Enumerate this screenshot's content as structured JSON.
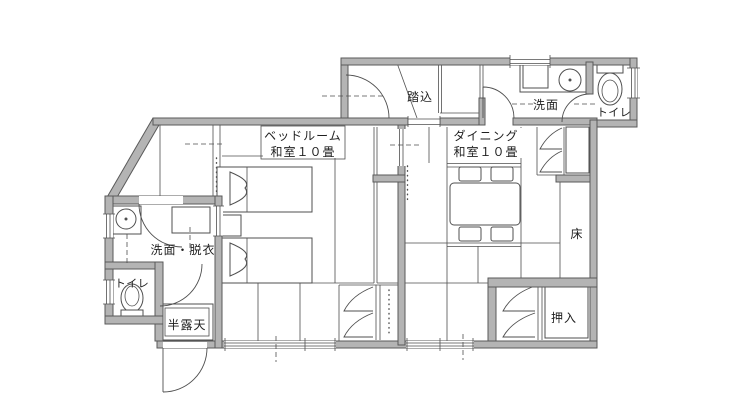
{
  "floorplan": {
    "colors": {
      "wall_fill": "#b4b4b4",
      "wall_edge": "#5a5a5a",
      "line": "#4f4f4f",
      "text": "#1f1f1f",
      "background": "#ffffff"
    },
    "rooms": {
      "entrance": "踏込",
      "washroom_upper": "洗面",
      "toilet_upper": "トイレ",
      "bedroom_line1": "ベッドルーム",
      "bedroom_line2": "和室１０畳",
      "dining_line1": "ダイニング",
      "dining_line2": "和室１０畳",
      "alcove": "床",
      "closet": "押入",
      "dressing": "洗面・脱衣",
      "toilet_lower": "トイレ",
      "bath": "半露天"
    }
  }
}
